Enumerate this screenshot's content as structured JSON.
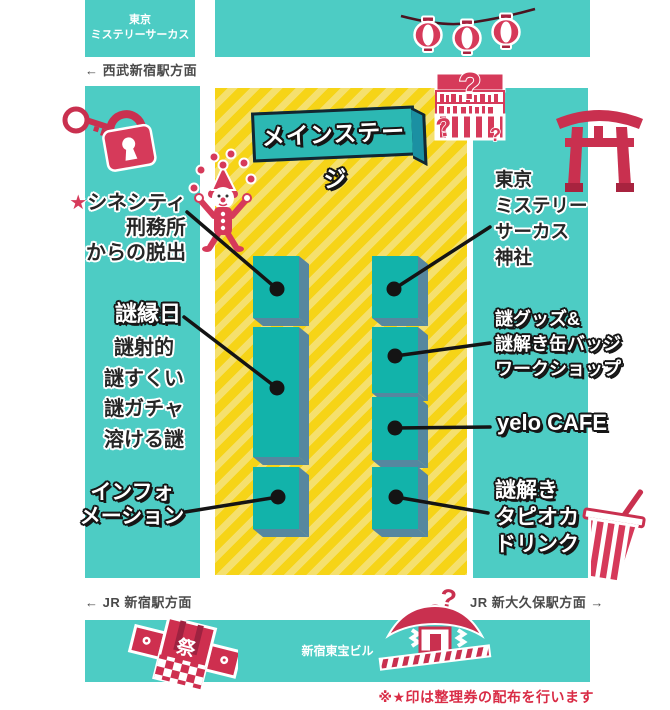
{
  "colors": {
    "teal_band": "#4DCCC4",
    "booth_teal": "#12B3AA",
    "booth_shadow": "#56879F",
    "stage_teal": "#2CB8B3",
    "floor_yellow": "#F6D417",
    "floor_yellow_light": "#F5E06E",
    "accent_red": "#D63A5A",
    "note_red": "#D92B45"
  },
  "top": {
    "building": "東京\nミステリーサーカス",
    "direction_seibu": "← 西武新宿駅方面"
  },
  "stage": {
    "label": "メインステージ"
  },
  "labels": {
    "cinecity": {
      "star": "★",
      "text": "シネシティ\n刑務所\nからの脱出"
    },
    "ennichi": {
      "title": "謎縁日",
      "items": "謎射的\n謎すくい\n謎ガチャ\n溶ける謎"
    },
    "information": {
      "text": "インフォ\nメーション"
    },
    "shrine": {
      "text": "東京\nミステリー\nサーカス\n神社"
    },
    "goods": {
      "text": "謎グッズ&\n謎解き缶バッジ\nワークショップ"
    },
    "cafe": {
      "text": "yelo CAFE"
    },
    "tapioca": {
      "text": "謎解き\nタピオカ\nドリンク"
    }
  },
  "bottom": {
    "direction_jr_shinjuku": "← JR 新宿駅方面",
    "direction_jr_shinokubo": "JR 新大久保駅方面 →",
    "building": "新宿東宝ビル",
    "note": "※★印は整理券の配布を行います"
  },
  "decor": {
    "question_mark": "?",
    "festival": "祭"
  }
}
